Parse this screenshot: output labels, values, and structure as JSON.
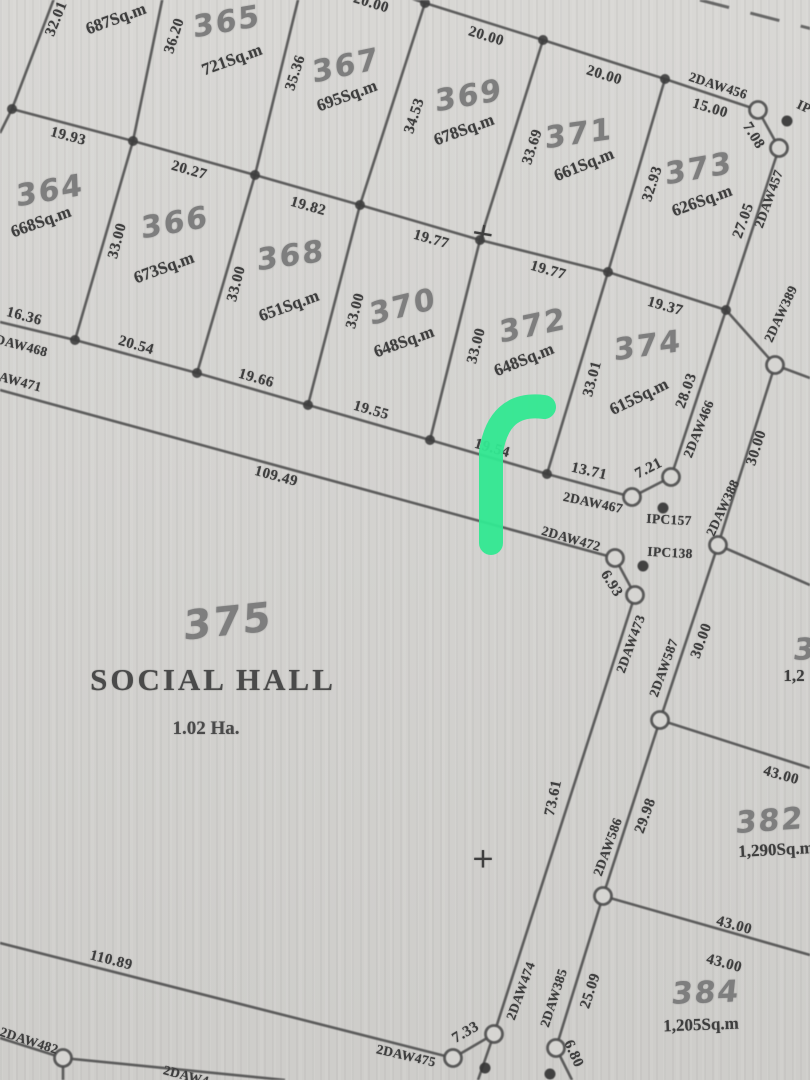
{
  "map": {
    "type": "cadastral-survey-plan",
    "paper_color": "#d6d5d2",
    "ink_color": "#4b4b4b",
    "highlight_color": "#31e891",
    "social_hall": {
      "plot_number": "375",
      "name": "SOCIAL HALL",
      "area": "1.02 Ha."
    },
    "parcels": [
      {
        "number": "",
        "area_sqm": "687Sq.m"
      },
      {
        "number": "364",
        "area_sqm": "668Sq.m"
      },
      {
        "number": "365",
        "area_sqm": "721Sq.m"
      },
      {
        "number": "366",
        "area_sqm": "673Sq.m"
      },
      {
        "number": "367",
        "area_sqm": "695Sq.m"
      },
      {
        "number": "368",
        "area_sqm": "651Sq.m"
      },
      {
        "number": "369",
        "area_sqm": "678Sq.m"
      },
      {
        "number": "370",
        "area_sqm": "648Sq.m"
      },
      {
        "number": "371",
        "area_sqm": "661Sq.m"
      },
      {
        "number": "372",
        "area_sqm": "648Sq.m"
      },
      {
        "number": "373",
        "area_sqm": "626Sq.m"
      },
      {
        "number": "374",
        "area_sqm": "615Sq.m"
      },
      {
        "number": "375",
        "area_sqm": "1.02 Ha.",
        "name": "SOCIAL HALL"
      },
      {
        "number": "382",
        "area_sqm": "1,290Sq.m"
      },
      {
        "number": "384",
        "area_sqm": "1,205Sq.m"
      },
      {
        "number": "3",
        "area_sqm": "1,2",
        "note": "cut off at right edge"
      }
    ],
    "labels": {
      "plot_numbers": [
        {
          "t": "365",
          "x": 227,
          "y": 22,
          "r": -10
        },
        {
          "t": "367",
          "x": 346,
          "y": 66,
          "r": -12
        },
        {
          "t": "369",
          "x": 469,
          "y": 96,
          "r": -10
        },
        {
          "t": "371",
          "x": 579,
          "y": 134,
          "r": -8
        },
        {
          "t": "373",
          "x": 699,
          "y": 169,
          "r": -10
        },
        {
          "t": "364",
          "x": 50,
          "y": 191,
          "r": -10
        },
        {
          "t": "366",
          "x": 175,
          "y": 223,
          "r": -10
        },
        {
          "t": "368",
          "x": 291,
          "y": 256,
          "r": -8
        },
        {
          "t": "370",
          "x": 403,
          "y": 307,
          "r": -14
        },
        {
          "t": "372",
          "x": 533,
          "y": 326,
          "r": -12
        },
        {
          "t": "374",
          "x": 648,
          "y": 346,
          "r": -8
        },
        {
          "t": "375",
          "x": 228,
          "y": 622,
          "r": -6,
          "s": 40
        },
        {
          "t": "382",
          "x": 770,
          "y": 821,
          "r": -4
        },
        {
          "t": "384",
          "x": 706,
          "y": 993,
          "r": -2
        },
        {
          "t": "3",
          "x": 805,
          "y": 650,
          "r": 0
        }
      ],
      "areas": [
        {
          "t": "687Sq.m",
          "x": 116,
          "y": 19,
          "r": -20
        },
        {
          "t": "721Sq.m",
          "x": 232,
          "y": 60,
          "r": -20
        },
        {
          "t": "695Sq.m",
          "x": 347,
          "y": 96,
          "r": -20
        },
        {
          "t": "678Sq.m",
          "x": 464,
          "y": 130,
          "r": -20
        },
        {
          "t": "661Sq.m",
          "x": 584,
          "y": 165,
          "r": -22
        },
        {
          "t": "626Sq.m",
          "x": 702,
          "y": 201,
          "r": -20
        },
        {
          "t": "668Sq.m",
          "x": 41,
          "y": 222,
          "r": -20
        },
        {
          "t": "673Sq.m",
          "x": 164,
          "y": 268,
          "r": -20
        },
        {
          "t": "651Sq.m",
          "x": 289,
          "y": 306,
          "r": -20
        },
        {
          "t": "648Sq.m",
          "x": 404,
          "y": 342,
          "r": -20
        },
        {
          "t": "648Sq.m",
          "x": 524,
          "y": 360,
          "r": -22
        },
        {
          "t": "615Sq.m",
          "x": 639,
          "y": 397,
          "r": -26
        },
        {
          "t": "1,290Sq.m",
          "x": 776,
          "y": 850,
          "r": -3
        },
        {
          "t": "1,205Sq.m",
          "x": 701,
          "y": 1025,
          "r": -2
        },
        {
          "t": "1,2",
          "x": 794,
          "y": 676,
          "r": 0
        }
      ],
      "dimensions": [
        {
          "t": "32.01",
          "x": 57,
          "y": 19,
          "r": -68
        },
        {
          "t": "20.00",
          "x": 371,
          "y": 4,
          "r": 17
        },
        {
          "t": "20.00",
          "x": 486,
          "y": 37,
          "r": 17
        },
        {
          "t": "20.00",
          "x": 604,
          "y": 76,
          "r": 17
        },
        {
          "t": "15.00",
          "x": 710,
          "y": 109,
          "r": 17
        },
        {
          "t": "7.08",
          "x": 753,
          "y": 136,
          "r": 58
        },
        {
          "t": "36.20",
          "x": 175,
          "y": 36,
          "r": -72
        },
        {
          "t": "35.36",
          "x": 296,
          "y": 73,
          "r": -72
        },
        {
          "t": "34.53",
          "x": 415,
          "y": 116,
          "r": -72
        },
        {
          "t": "33.69",
          "x": 533,
          "y": 147,
          "r": -72
        },
        {
          "t": "32.93",
          "x": 653,
          "y": 184,
          "r": -72
        },
        {
          "t": "27.05",
          "x": 744,
          "y": 221,
          "r": -70
        },
        {
          "t": "19.93",
          "x": 68,
          "y": 137,
          "r": 15
        },
        {
          "t": "20.27",
          "x": 189,
          "y": 171,
          "r": 16
        },
        {
          "t": "19.82",
          "x": 308,
          "y": 207,
          "r": 16
        },
        {
          "t": "19.77",
          "x": 431,
          "y": 240,
          "r": 16
        },
        {
          "t": "19.77",
          "x": 548,
          "y": 271,
          "r": 16
        },
        {
          "t": "19.37",
          "x": 665,
          "y": 307,
          "r": 16
        },
        {
          "t": "33.00",
          "x": 118,
          "y": 241,
          "r": -75
        },
        {
          "t": "33.00",
          "x": 237,
          "y": 284,
          "r": -75
        },
        {
          "t": "33.00",
          "x": 356,
          "y": 311,
          "r": -75
        },
        {
          "t": "33.00",
          "x": 477,
          "y": 346,
          "r": -75
        },
        {
          "t": "33.01",
          "x": 593,
          "y": 379,
          "r": -75
        },
        {
          "t": "28.03",
          "x": 687,
          "y": 391,
          "r": -70
        },
        {
          "t": "16.36",
          "x": 24,
          "y": 317,
          "r": 15
        },
        {
          "t": "20.54",
          "x": 136,
          "y": 346,
          "r": 16
        },
        {
          "t": "19.66",
          "x": 256,
          "y": 379,
          "r": 16
        },
        {
          "t": "19.55",
          "x": 371,
          "y": 411,
          "r": 16
        },
        {
          "t": "19.54",
          "x": 492,
          "y": 449,
          "r": 16
        },
        {
          "t": "13.71",
          "x": 589,
          "y": 472,
          "r": 13
        },
        {
          "t": "7.21",
          "x": 649,
          "y": 469,
          "r": -27
        },
        {
          "t": "109.49",
          "x": 276,
          "y": 477,
          "r": 15
        },
        {
          "t": "6.93",
          "x": 611,
          "y": 584,
          "r": 58
        },
        {
          "t": "30.00",
          "x": 757,
          "y": 448,
          "r": -72
        },
        {
          "t": "30.00",
          "x": 702,
          "y": 641,
          "r": -70
        },
        {
          "t": "29.98",
          "x": 646,
          "y": 816,
          "r": -70
        },
        {
          "t": "25.09",
          "x": 591,
          "y": 991,
          "r": -72
        },
        {
          "t": "6.80",
          "x": 573,
          "y": 1054,
          "r": 66
        },
        {
          "t": "73.61",
          "x": 554,
          "y": 798,
          "r": -78
        },
        {
          "t": "43.00",
          "x": 781,
          "y": 776,
          "r": 16
        },
        {
          "t": "43.00",
          "x": 734,
          "y": 926,
          "r": 15
        },
        {
          "t": "43.00",
          "x": 724,
          "y": 964,
          "r": 15
        },
        {
          "t": "110.89",
          "x": 111,
          "y": 961,
          "r": 14
        },
        {
          "t": "7.33",
          "x": 466,
          "y": 1033,
          "r": -30
        }
      ],
      "beacons": [
        {
          "t": "2DAW456",
          "x": 718,
          "y": 86,
          "r": 18
        },
        {
          "t": "2DAW457",
          "x": 769,
          "y": 199,
          "r": -70
        },
        {
          "t": "2DAW389",
          "x": 781,
          "y": 314,
          "r": -65
        },
        {
          "t": "2DAW388",
          "x": 723,
          "y": 508,
          "r": -65
        },
        {
          "t": "2DAW466",
          "x": 699,
          "y": 429,
          "r": -68
        },
        {
          "t": "2DAW467",
          "x": 593,
          "y": 503,
          "r": 12
        },
        {
          "t": "2DAW472",
          "x": 571,
          "y": 539,
          "r": 16
        },
        {
          "t": "2DAW473",
          "x": 631,
          "y": 644,
          "r": -70
        },
        {
          "t": "2DAW587",
          "x": 664,
          "y": 668,
          "r": -70
        },
        {
          "t": "2DAW586",
          "x": 608,
          "y": 847,
          "r": -70
        },
        {
          "t": "2DAW385",
          "x": 554,
          "y": 998,
          "r": -72
        },
        {
          "t": "2DAW474",
          "x": 521,
          "y": 991,
          "r": -70
        },
        {
          "t": "2DAW475",
          "x": 406,
          "y": 1056,
          "r": 13
        },
        {
          "t": "2DAW482",
          "x": 29,
          "y": 1041,
          "r": 18
        },
        {
          "t": "2DAW468",
          "x": 18,
          "y": 345,
          "r": 15
        },
        {
          "t": "2DAW471",
          "x": 12,
          "y": 380,
          "r": 15
        },
        {
          "t": "2DAW4",
          "x": 186,
          "y": 1076,
          "r": 15
        },
        {
          "t": "IPC157",
          "x": 669,
          "y": 520,
          "r": 3
        },
        {
          "t": "IPC138",
          "x": 670,
          "y": 553,
          "r": 3
        },
        {
          "t": "IP",
          "x": 804,
          "y": 107,
          "r": 25
        }
      ],
      "titles": [
        {
          "t": "SOCIAL HALL",
          "x": 213,
          "y": 680,
          "r": 0,
          "cls": "title"
        },
        {
          "t": "1.02 Ha.",
          "x": 206,
          "y": 729,
          "r": 0,
          "cls": "subtitle"
        }
      ],
      "crosses": [
        {
          "t": "+",
          "x": 483,
          "y": 233,
          "r": 10
        },
        {
          "t": "+",
          "x": 483,
          "y": 858,
          "r": 0
        }
      ]
    },
    "geometry": {
      "lines": [
        [
          [
            55,
            -4
          ],
          [
            12,
            109
          ],
          [
            0,
            133
          ]
        ],
        [
          [
            12,
            109
          ],
          [
            133,
            141
          ],
          [
            255,
            175
          ],
          [
            360,
            205
          ],
          [
            480,
            240
          ],
          [
            608,
            272
          ],
          [
            726,
            310
          ]
        ],
        [
          [
            398,
            -6
          ],
          [
            425,
            3
          ],
          [
            543,
            40
          ],
          [
            665,
            79
          ],
          [
            758,
            110
          ]
        ],
        [
          [
            133,
            141
          ],
          [
            163,
            -4
          ]
        ],
        [
          [
            255,
            175
          ],
          [
            299,
            -4
          ]
        ],
        [
          [
            360,
            205
          ],
          [
            425,
            3
          ]
        ],
        [
          [
            480,
            240
          ],
          [
            543,
            40
          ]
        ],
        [
          [
            608,
            272
          ],
          [
            665,
            79
          ]
        ],
        [
          [
            726,
            310
          ],
          [
            779,
            148
          ]
        ],
        [
          [
            133,
            141
          ],
          [
            75,
            340
          ]
        ],
        [
          [
            255,
            175
          ],
          [
            197,
            373
          ]
        ],
        [
          [
            360,
            205
          ],
          [
            308,
            405
          ]
        ],
        [
          [
            480,
            240
          ],
          [
            430,
            440
          ]
        ],
        [
          [
            608,
            272
          ],
          [
            547,
            474
          ]
        ],
        [
          [
            726,
            310
          ],
          [
            671,
            477
          ]
        ],
        [
          [
            0,
            322
          ],
          [
            75,
            340
          ],
          [
            197,
            373
          ],
          [
            308,
            405
          ],
          [
            430,
            440
          ],
          [
            547,
            474
          ],
          [
            632,
            497
          ],
          [
            671,
            477
          ]
        ],
        [
          [
            0,
            390
          ],
          [
            615,
            558
          ],
          [
            635,
            595
          ],
          [
            494,
            1034
          ],
          [
            453,
            1058
          ]
        ],
        [
          [
            0,
            943
          ],
          [
            453,
            1058
          ]
        ],
        [
          [
            758,
            110
          ],
          [
            779,
            148
          ]
        ],
        [
          [
            726,
            310
          ],
          [
            775,
            365
          ],
          [
            718,
            545
          ],
          [
            660,
            720
          ],
          [
            603,
            896
          ],
          [
            556,
            1048
          ],
          [
            572,
            1080
          ]
        ],
        [
          [
            775,
            365
          ],
          [
            810,
            378
          ]
        ],
        [
          [
            718,
            545
          ],
          [
            810,
            585
          ]
        ],
        [
          [
            660,
            720
          ],
          [
            810,
            768
          ]
        ],
        [
          [
            603,
            896
          ],
          [
            810,
            955
          ]
        ],
        [
          [
            494,
            1034
          ],
          [
            478,
            1080
          ]
        ],
        [
          [
            0,
            1038
          ],
          [
            63,
            1058
          ],
          [
            285,
            1080
          ]
        ],
        [
          [
            63,
            1058
          ],
          [
            63,
            1080
          ]
        ]
      ],
      "dashed_lines": [
        [
          [
            700,
            0
          ],
          [
            816,
            30
          ]
        ]
      ],
      "circles": [
        [
          758,
          110
        ],
        [
          779,
          148
        ],
        [
          775,
          365
        ],
        [
          718,
          545
        ],
        [
          660,
          720
        ],
        [
          603,
          896
        ],
        [
          556,
          1048
        ],
        [
          671,
          477
        ],
        [
          632,
          497
        ],
        [
          615,
          558
        ],
        [
          635,
          595
        ],
        [
          494,
          1034
        ],
        [
          453,
          1058
        ],
        [
          63,
          1058
        ]
      ],
      "nodes": [
        [
          425,
          3
        ],
        [
          543,
          40
        ],
        [
          665,
          79
        ],
        [
          12,
          109
        ],
        [
          133,
          141
        ],
        [
          255,
          175
        ],
        [
          360,
          205
        ],
        [
          480,
          240
        ],
        [
          608,
          272
        ],
        [
          726,
          310
        ],
        [
          75,
          340
        ],
        [
          197,
          373
        ],
        [
          308,
          405
        ],
        [
          430,
          440
        ],
        [
          547,
          474
        ]
      ],
      "dots": [
        [
          787,
          121
        ],
        [
          663,
          508
        ],
        [
          643,
          566
        ],
        [
          485,
          1068
        ],
        [
          550,
          1074
        ]
      ],
      "highlight_path": "M 544 407 C 512 403 496 420 491 452 L 491 543"
    }
  }
}
